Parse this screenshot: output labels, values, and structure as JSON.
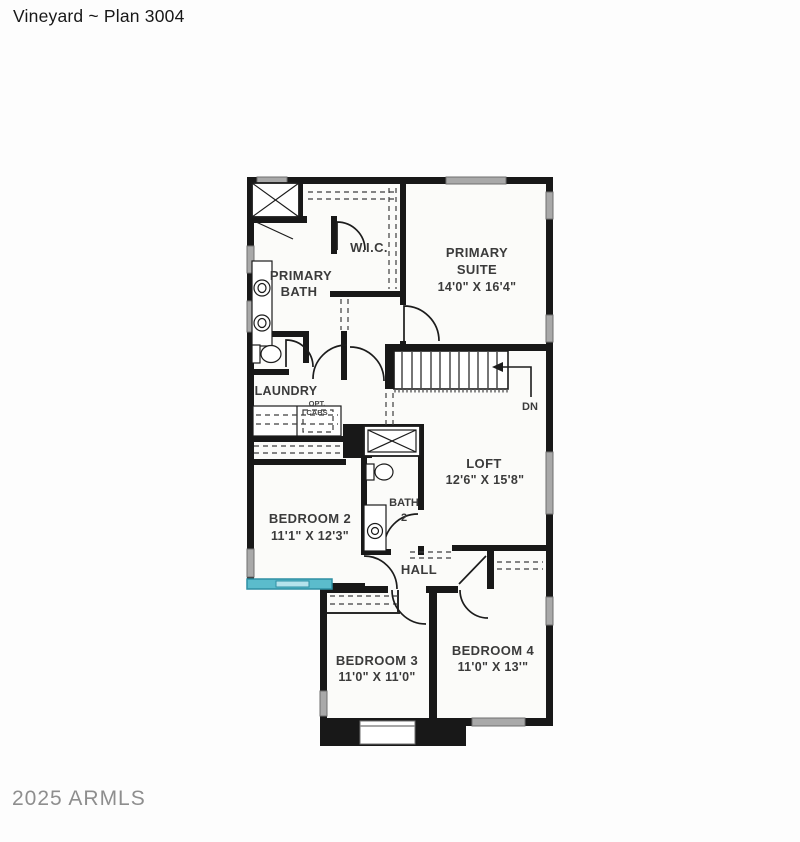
{
  "header": {
    "title": "Vineyard ~ Plan 3004"
  },
  "watermark": {
    "text": "2025 ARMLS"
  },
  "colors": {
    "wall": "#181818",
    "window": "#a9a9a9",
    "accent_window": "#5bbccc",
    "accent_window_light": "#b5e3ec",
    "accent_border": "#2e8fa3",
    "label": "#3b3b3b",
    "watermark": "#8e8e8e",
    "title": "#181818",
    "background": "#fdfdfd",
    "room_fill": "#fbfbf9"
  },
  "plan": {
    "rooms": {
      "wic": {
        "name": "W.I.C."
      },
      "primary_bath": {
        "name_line1": "PRIMARY",
        "name_line2": "BATH"
      },
      "primary_suite": {
        "name_line1": "PRIMARY",
        "name_line2": "SUITE",
        "dimensions": "14'0\" X 16'4\""
      },
      "laundry": {
        "name": "LAUNDRY",
        "option_line1": "OPT.",
        "option_line2": "CABS"
      },
      "loft": {
        "name": "LOFT",
        "dimensions": "12'6\" X 15'8\""
      },
      "bedroom_2": {
        "name": "BEDROOM 2",
        "dimensions": "11'1\" X 12'3\""
      },
      "bath_2": {
        "name_line1": "BATH",
        "name_line2": "2"
      },
      "hall": {
        "name": "HALL"
      },
      "bedroom_3": {
        "name": "BEDROOM 3",
        "dimensions": "11'0\" X 11'0\""
      },
      "bedroom_4": {
        "name": "BEDROOM 4",
        "dimensions": "11'0\" X 13'\""
      }
    },
    "stairs": {
      "direction_label": "DN"
    }
  }
}
